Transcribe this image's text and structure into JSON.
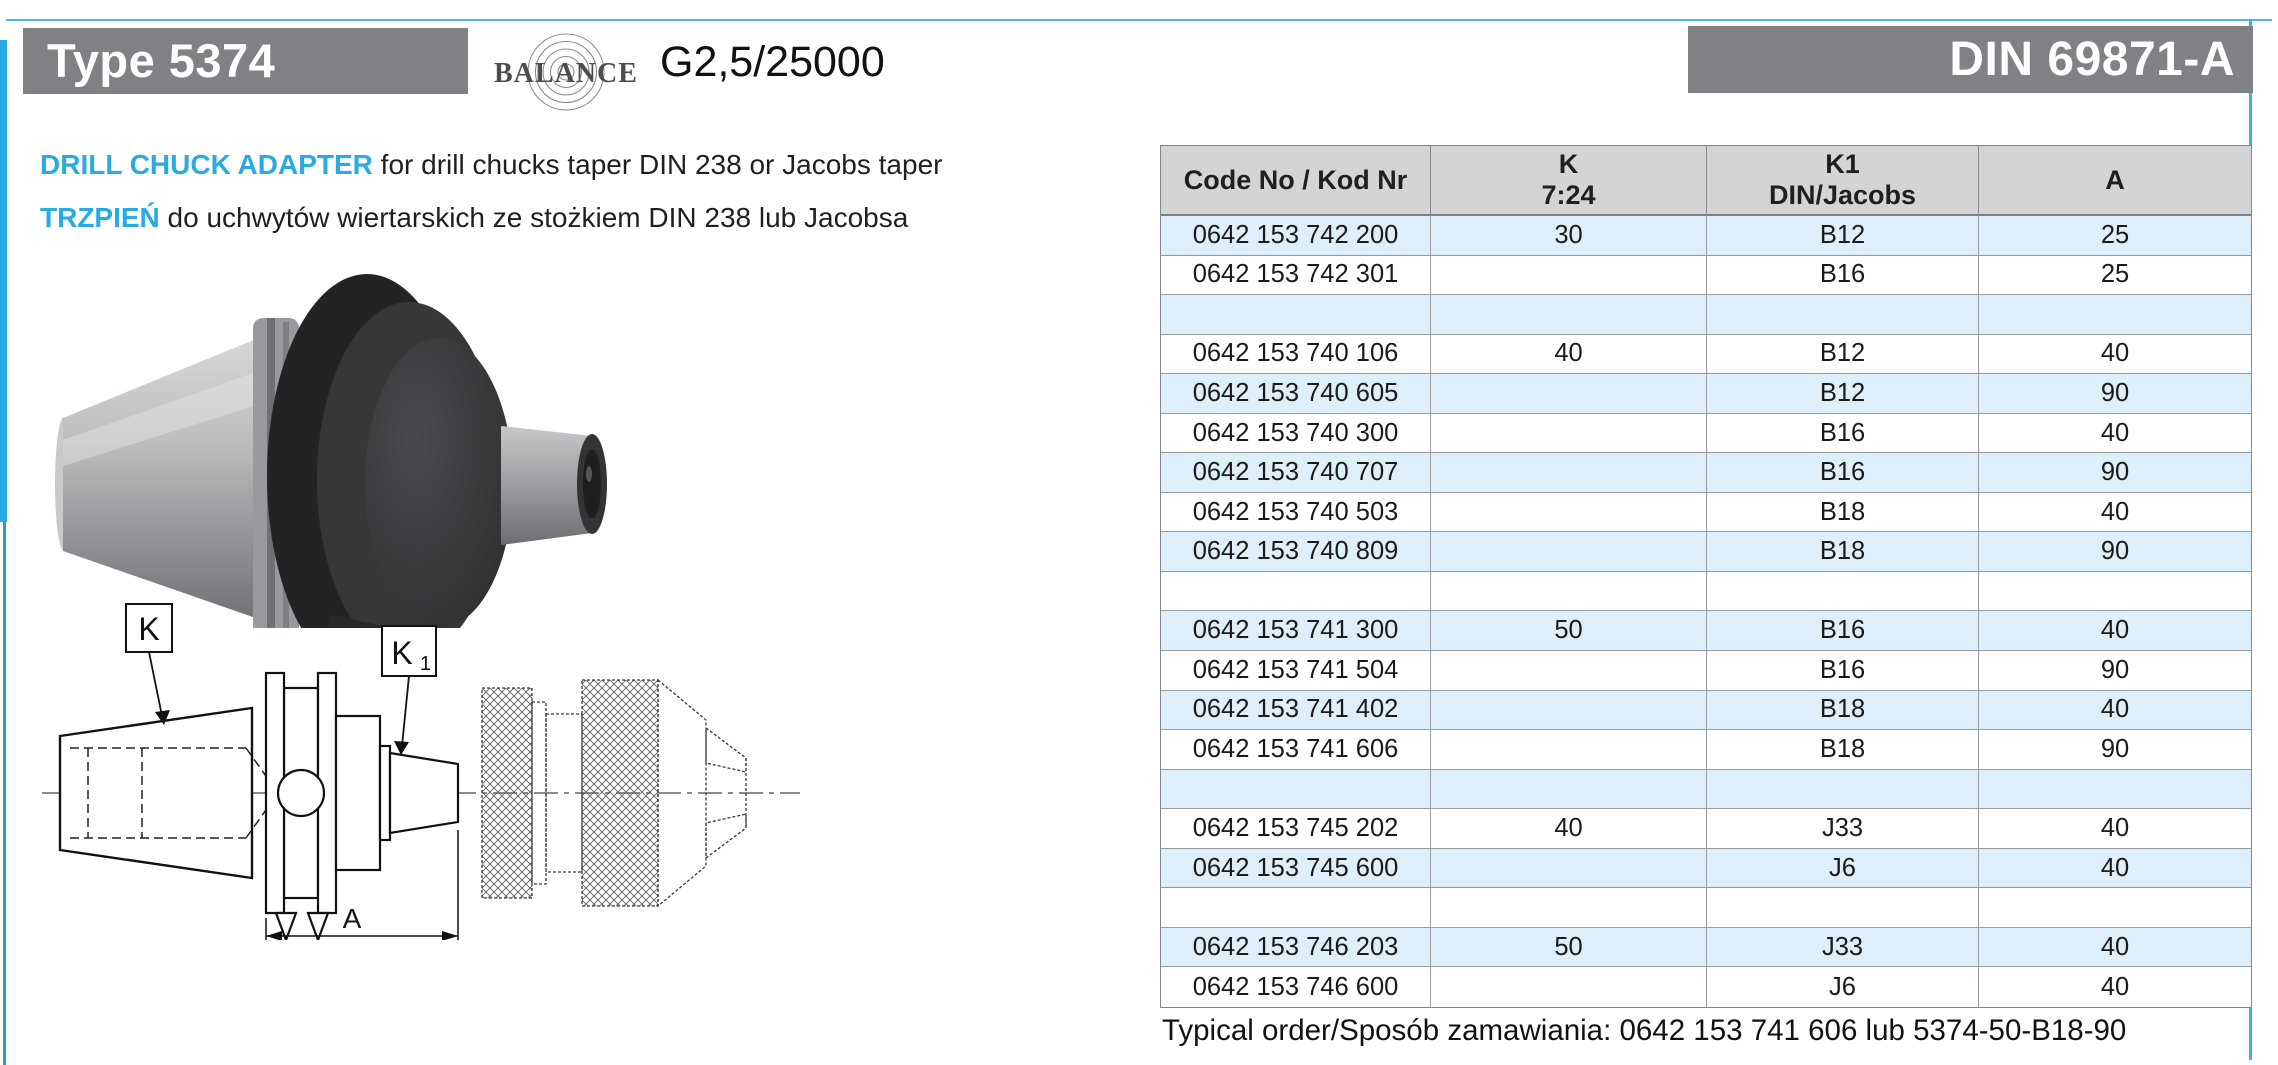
{
  "colors": {
    "accent_cyan": "#29abe2",
    "header_box_gray": "#7f8184",
    "table_header_bg": "#d2d4d5",
    "table_row_blue": "#ddeffa",
    "table_border": "#999b9d"
  },
  "header": {
    "type_label": "Type 5374",
    "balance_word": "BALANCE",
    "balance_grade": "G2,5/25000",
    "din_label": "DIN 69871-A"
  },
  "description": {
    "line1_highlight": "DRILL CHUCK ADAPTER",
    "line1_rest": " for drill chucks taper DIN 238 or Jacobs taper",
    "line2_highlight": "TRZPIEŃ",
    "line2_rest": " do uchwytów wiertarskich ze stożkiem DIN 238 lub Jacobsa"
  },
  "drawing": {
    "label_k": "K",
    "label_k1_main": "K",
    "label_k1_sub": "1",
    "label_a": "A"
  },
  "table": {
    "headers": [
      {
        "line1": "Code No / Kod Nr",
        "line2": ""
      },
      {
        "line1": "K",
        "line2": "7:24"
      },
      {
        "line1": "K1",
        "line2": "DIN/Jacobs"
      },
      {
        "line1": "A",
        "line2": ""
      }
    ],
    "rows": [
      {
        "code": "0642 153 742 200",
        "k": "30",
        "k1": "B12",
        "a": "25"
      },
      {
        "code": "0642 153 742 301",
        "k": "",
        "k1": "B16",
        "a": "25"
      },
      {
        "code": "",
        "k": "",
        "k1": "",
        "a": ""
      },
      {
        "code": "0642 153 740 106",
        "k": "40",
        "k1": "B12",
        "a": "40"
      },
      {
        "code": "0642 153 740 605",
        "k": "",
        "k1": "B12",
        "a": "90"
      },
      {
        "code": "0642 153 740 300",
        "k": "",
        "k1": "B16",
        "a": "40"
      },
      {
        "code": "0642 153 740 707",
        "k": "",
        "k1": "B16",
        "a": "90"
      },
      {
        "code": "0642 153 740 503",
        "k": "",
        "k1": "B18",
        "a": "40"
      },
      {
        "code": "0642 153 740 809",
        "k": "",
        "k1": "B18",
        "a": "90"
      },
      {
        "code": "",
        "k": "",
        "k1": "",
        "a": ""
      },
      {
        "code": "0642 153 741 300",
        "k": "50",
        "k1": "B16",
        "a": "40"
      },
      {
        "code": "0642 153 741 504",
        "k": "",
        "k1": "B16",
        "a": "90"
      },
      {
        "code": "0642 153 741 402",
        "k": "",
        "k1": "B18",
        "a": "40"
      },
      {
        "code": "0642 153 741 606",
        "k": "",
        "k1": "B18",
        "a": "90"
      },
      {
        "code": "",
        "k": "",
        "k1": "",
        "a": ""
      },
      {
        "code": "0642 153 745 202",
        "k": "40",
        "k1": "J33",
        "a": "40"
      },
      {
        "code": "0642 153 745 600",
        "k": "",
        "k1": "J6",
        "a": "40"
      },
      {
        "code": "",
        "k": "",
        "k1": "",
        "a": ""
      },
      {
        "code": "0642 153 746 203",
        "k": "50",
        "k1": "J33",
        "a": "40"
      },
      {
        "code": "0642 153 746 600",
        "k": "",
        "k1": "J6",
        "a": "40"
      }
    ]
  },
  "footer": {
    "typical_order": "Typical order/Sposób zamawiania: 0642 153 741 606 lub 5374-50-B18-90"
  }
}
